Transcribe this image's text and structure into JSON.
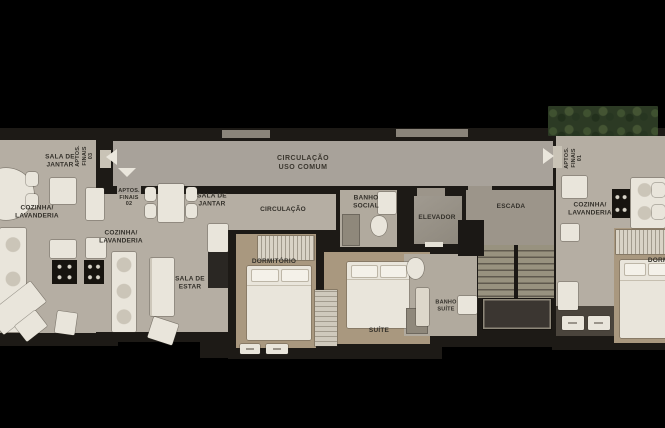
{
  "plan": {
    "type": "residential floor plan",
    "common": {
      "corridor": "CIRCULAÇÃO\nUSO COMUM",
      "elevator": "ELEVADOR",
      "stairs": "ESCADA"
    },
    "apt03": {
      "tag": "APTOS.\nFINAIS\n03",
      "dining": "SALA DE\nJANTAR",
      "kitchen": "COZINHA/\nLAVANDERIA"
    },
    "apt02": {
      "tag": "APTOS.\nFINAIS\n02",
      "dining": "SALA DE\nJANTAR",
      "hall": "CIRCULAÇÃO",
      "kitchen": "COZINHA/\nLAVANDERIA",
      "living": "SALA DE\nESTAR",
      "bedroom": "DORMITÓRIO",
      "suite": "SUÍTE",
      "bath_social": "BANHO\nSOCIAL",
      "bath_suite": "BANHO\nSUÍTE"
    },
    "apt01": {
      "tag": "APTOS.\nFINAIS\n01",
      "kitchen": "COZINHA/\nLAVANDERIA",
      "bedroom": "DORMITÓRIO"
    }
  },
  "colors": {
    "background": "#000000",
    "wall": "#1d1a16",
    "floor": "#b5aea3",
    "floor_corridor": "#a8a29a",
    "floor_bedroom": "#a9987f",
    "floor_bath": "#b1aa9e",
    "floor_stairwell": "#9c958a",
    "furniture": "#e9e5db",
    "appliance": "#17140f",
    "greenery": "#2c3a24",
    "label_text": "#33302a",
    "arrow": "#eae6dc"
  }
}
